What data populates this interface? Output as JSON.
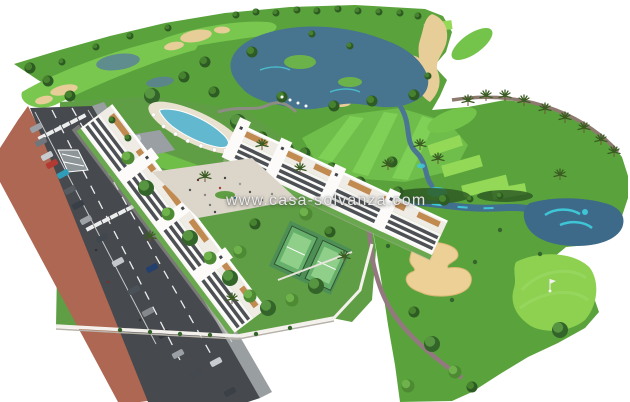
{
  "watermark": {
    "text": "www.casa-solvanza.com"
  },
  "image": {
    "alt": "Aerial 3D render of a white apartment resort complex beside a golf course with lakes, sand bunkers, palm trees, a pool, padel courts and a road with cars"
  },
  "palette": {
    "rough_green": "#5aa33c",
    "fairway_green": "#79c74f",
    "tee_green": "#93d957",
    "putting_green": "#8ed150",
    "sand": "#e7cd97",
    "lake_blue": "#47748f",
    "teal_water": "#3ec5d6",
    "asphalt": "#46494e",
    "sidewalk_terracotta": "#ad6752",
    "building_white": "#f8f6f2",
    "window_band": "#4d5156",
    "terrace_terracotta": "#c08a50",
    "pool_blue": "#62b8cf"
  }
}
